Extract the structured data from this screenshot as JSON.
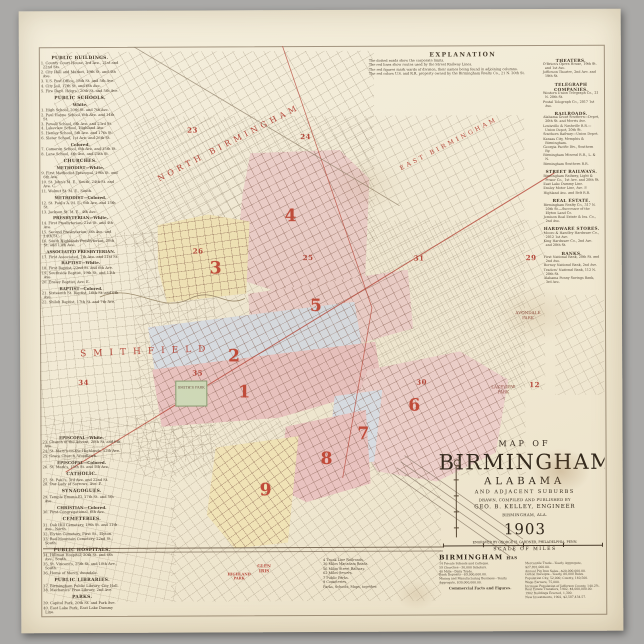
{
  "colors": {
    "red": "#b5473a",
    "pink": "#eccfca",
    "rose": "#e9c3c0",
    "yellow": "#f0e3b6",
    "blue": "#d8dde3",
    "paper": "#f2ecd9"
  },
  "explanation": {
    "title": "EXPLANATION",
    "lines": [
      "The dotted roads show the corporate limits.",
      "The red lines show routes used by the Street Railway Lines.",
      "The red figures mark wards of division, their names being found in adjoining columns.",
      "The red colors U.S. and R.R. property owned by the Birmingham Realty Co., 21 N. 20th St."
    ]
  },
  "left_top": {
    "rows": [
      {
        "t": "h",
        "x": "PUBLIC BUILDINGS."
      },
      {
        "t": "i",
        "x": "1. County Court House, 3rd Ave., 21st and 22nd Sts."
      },
      {
        "t": "i",
        "x": "2. City Hall and Market, 19th St. and 4th Ave."
      },
      {
        "t": "i",
        "x": "3. U.S. Post Office, 18th St. and 5th Ave."
      },
      {
        "t": "i",
        "x": "4. City Jail, 17th St. and 6th Ave."
      },
      {
        "t": "i",
        "x": "5. Fire Dept. Hdqrs., 20th St. and 5th Ave."
      },
      {
        "t": "h",
        "x": "PUBLIC SCHOOLS."
      },
      {
        "t": "s",
        "x": "White."
      },
      {
        "t": "i",
        "x": "1. High School, 20th St. and 7th Ave."
      },
      {
        "t": "i",
        "x": "2. Paul Hayne School, 6th Ave. and 14th St."
      },
      {
        "t": "i",
        "x": "3. Powell School, 6th Ave. and 23rd St."
      },
      {
        "t": "i",
        "x": "4. Lakeview School, Highland Ave."
      },
      {
        "t": "i",
        "x": "5. Henley School, 5th Ave. and 17th St."
      },
      {
        "t": "i",
        "x": "6. Slater School, 1st Ave. and 26th St."
      },
      {
        "t": "s",
        "x": "Colored."
      },
      {
        "t": "i",
        "x": "7. Cameron School, 6th Ave. and 15th St."
      },
      {
        "t": "i",
        "x": "8. Lane School, 4th Ave. and 24th St."
      },
      {
        "t": "h",
        "x": "CHURCHES."
      },
      {
        "t": "s",
        "x": "METHODIST—White."
      },
      {
        "t": "i",
        "x": "9. First Methodist Episcopal, 19th St. and 6th Ave."
      },
      {
        "t": "i",
        "x": "10. St. John's M. E., South, 24th St. and Ave. C."
      },
      {
        "t": "i",
        "x": "11. Walnut St. M. E., South."
      },
      {
        "t": "s",
        "x": "METHODIST—Colored."
      },
      {
        "t": "i",
        "x": "12. St. Paul's A. M. E., 6th Ave. and 15th St."
      },
      {
        "t": "i",
        "x": "13. Jackson St. M. E., 4th Ave."
      },
      {
        "t": "s",
        "x": "PRESBYTERIAN—White."
      },
      {
        "t": "i",
        "x": "14. First Presbyterian, 21st St. and 4th Ave."
      },
      {
        "t": "i",
        "x": "15. Second Presbyterian, 6th Ave. and 14th St."
      },
      {
        "t": "i",
        "x": "16. South Highlands Presbyterian, 20th St. and 11th Ave."
      },
      {
        "t": "s",
        "x": "ASSOCIATED PRESBYTERIAN."
      },
      {
        "t": "i",
        "x": "17. First Associated, 7th Ave. and 21st St."
      },
      {
        "t": "s",
        "x": "BAPTIST—White."
      },
      {
        "t": "i",
        "x": "18. First Baptist, 22nd St. and 6th Ave."
      },
      {
        "t": "i",
        "x": "19. Southside Baptist, 19th St. and 11th Ave."
      },
      {
        "t": "i",
        "x": "20. Ensley Baptist, Ave. E."
      },
      {
        "t": "s",
        "x": "BAPTIST—Colored."
      },
      {
        "t": "i",
        "x": "21. Sixteenth St. Baptist, 16th St. and 6th Ave."
      },
      {
        "t": "i",
        "x": "22. Shiloh Baptist, 17th St. and 7th Ave."
      }
    ]
  },
  "left_bottom": {
    "rows": [
      {
        "t": "s",
        "x": "EPISCOPAL—White."
      },
      {
        "t": "i",
        "x": "23. Church of the Advent, 20th St. and 6th Ave."
      },
      {
        "t": "i",
        "x": "24. St. Mary's-on-the-Highlands, 12th Ave."
      },
      {
        "t": "i",
        "x": "25. Grace Church, Woodlawn."
      },
      {
        "t": "s",
        "x": "EPISCOPAL—Colored."
      },
      {
        "t": "i",
        "x": "26. St. Mark's, 15th St. and 5th Ave."
      },
      {
        "t": "h",
        "x": "CATHOLIC."
      },
      {
        "t": "i",
        "x": "27. St. Paul's, 3rd Ave. and 22nd St."
      },
      {
        "t": "i",
        "x": "28. Our Lady of Sorrows, Ave. F."
      },
      {
        "t": "h",
        "x": "SYNAGOGUES."
      },
      {
        "t": "i",
        "x": "29. Temple Emanu-El, 17th St. and 5th Ave."
      },
      {
        "t": "s",
        "x": "CHRISTIAN—Colored."
      },
      {
        "t": "i",
        "x": "30. First Congregational, 6th Ave."
      },
      {
        "t": "h",
        "x": "CEMETERIES."
      },
      {
        "t": "i",
        "x": "31. Oak Hill Cemetery, 19th St. and 11th Ave., North."
      },
      {
        "t": "i",
        "x": "32. Elyton Cemetery, First St., Elyton."
      },
      {
        "t": "i",
        "x": "33. Red Mountain Cemetery, 22nd St., South."
      },
      {
        "t": "h",
        "x": "PUBLIC HOSPITALS."
      },
      {
        "t": "i",
        "x": "34. Hillman Hospital, 20th St. and 6th Ave., South."
      },
      {
        "t": "i",
        "x": "35. St. Vincent's, 25th St. and 10th Ave., South."
      },
      {
        "t": "i",
        "x": "36. Home of Mercy, Avondale."
      },
      {
        "t": "h",
        "x": "PUBLIC LIBRARIES."
      },
      {
        "t": "i",
        "x": "37. Birmingham Public Library, City Hall."
      },
      {
        "t": "i",
        "x": "38. Mechanics' Free Library, 2nd Ave."
      },
      {
        "t": "h",
        "x": "PARKS."
      },
      {
        "t": "i",
        "x": "39. Capitol Park, 20th St. and Park Ave."
      },
      {
        "t": "i",
        "x": "40. East Lake Park, East Lake Dummy Line."
      },
      {
        "t": "i",
        "x": "41. Lakeview Park, Highland Ave. and Clairmont."
      },
      {
        "t": "i",
        "x": "42. Avondale Park, 5th Ave., Avondale."
      },
      {
        "t": "i",
        "x": "43. Smith's Park, 8th Ave. and 8th St."
      },
      {
        "t": "i",
        "x": "44. Highland Park, Glen Iris and 11th Pl."
      },
      {
        "t": "i",
        "x": "45. Glen Iris Park, South Elyton."
      }
    ]
  },
  "right_col": {
    "rows": [
      {
        "t": "h",
        "x": "THEATERS."
      },
      {
        "t": "i",
        "x": "O'Brien's Opera House, 19th St. and 1st Ave."
      },
      {
        "t": "i",
        "x": "Jefferson Theatre, 2nd Ave. and 19th St."
      },
      {
        "t": "h",
        "x": "TELEGRAPH COMPANIES."
      },
      {
        "t": "i",
        "x": "Western Union Telegraph Co., 21 N. 20th St."
      },
      {
        "t": "i",
        "x": "Postal Telegraph Co., 2017 1st Ave."
      },
      {
        "t": "h",
        "x": "RAILROADS."
      },
      {
        "t": "i",
        "x": "Alabama Great Southern—Depot, 20th St. and Morris Ave."
      },
      {
        "t": "i",
        "x": "Louisville & Nashville R.R.—Union Depot, 20th St."
      },
      {
        "t": "i",
        "x": "Southern Railway—Union Depot."
      },
      {
        "t": "i",
        "x": "Kansas City, Memphis & Birmingham."
      },
      {
        "t": "i",
        "x": "Georgia Pacific Div., Southern Ry."
      },
      {
        "t": "i",
        "x": "Birmingham Mineral R.R., L. & N."
      },
      {
        "t": "i",
        "x": "Birmingham Southern R.R."
      },
      {
        "t": "h",
        "x": "STREET RAILWAYS."
      },
      {
        "t": "i",
        "x": "Birmingham Railway, Light & Power Co., 1st Ave. and 20th St."
      },
      {
        "t": "i",
        "x": "East Lake Dummy Line."
      },
      {
        "t": "i",
        "x": "Ensley Motor Line, Ave. F."
      },
      {
        "t": "i",
        "x": "Highland Ave. and Belt R.R."
      },
      {
        "t": "h",
        "x": "REAL ESTATE."
      },
      {
        "t": "i",
        "x": "Birmingham Realty Co., 317 N. 20th St.—Successor of the Elyton Land Co."
      },
      {
        "t": "i",
        "x": "Jemison Real Estate & Ins. Co., 2nd Ave."
      },
      {
        "t": "h",
        "x": "HARDWARE STORES."
      },
      {
        "t": "i",
        "x": "Moore & Handley Hardware Co., 2012 1st Ave."
      },
      {
        "t": "i",
        "x": "King Hardware Co., 2nd Ave. and 20th St."
      },
      {
        "t": "h",
        "x": "BANKS."
      },
      {
        "t": "i",
        "x": "First National Bank, 20th St. and 2nd Ave."
      },
      {
        "t": "i",
        "x": "Berney National Bank, 2nd Ave."
      },
      {
        "t": "i",
        "x": "Traders' National Bank, 112 N. 20th St."
      },
      {
        "t": "i",
        "x": "Alabama Penny Savings Bank, 3rd Ave."
      }
    ]
  },
  "map": {
    "district_numbers": [
      "1",
      "2",
      "3",
      "4",
      "5",
      "6",
      "7",
      "8",
      "9"
    ],
    "ward_numbers": [
      "23",
      "24",
      "26",
      "25",
      "31",
      "29",
      "35",
      "34",
      "30",
      "12"
    ],
    "labels": {
      "north_birmingham": "NORTH BIRMINGHAM",
      "east_birmingham": "EAST BIRMINGHAM",
      "smithfield": "SMITHFIELD",
      "avondale_park": "AVONDALE PARK",
      "lakeview_park": "LAKEVIEW PARK",
      "smiths_park": "SMITH'S PARK",
      "highland_park": "HIGHLAND PARK",
      "glen_iris": "GLEN IRIS"
    }
  },
  "title_block": {
    "map_of": "MAP OF",
    "city": "BIRMINGHAM",
    "state": "ALABAMA",
    "suburbs": "AND ADJACENT SUBURBS",
    "drawn": "DRAWN, COMPILED AND PUBLISHED BY",
    "author": "GEO. B. KELLEY, ENGINEER",
    "place": "BIRMINGHAM, ALA.",
    "year": "1903",
    "engraved": "ENGRAVED BY GEORGE H. GARDNER, PHILADELPHIA, PENN.",
    "scale": "SCALE OF MILES"
  },
  "index": {
    "heading": "BIRMINGHAM",
    "lines": [
      "4 Trunk Line Railroads.",
      "30 Miles Macadam Roads.",
      "56 Miles Street Railway.",
      "62 Miles Sewers.",
      "7 Public Parks.",
      "9 Cemeteries.",
      "Parks, Schools, Maps, together."
    ]
  },
  "stats": {
    "heading_main": "BIRMINGHAM",
    "heading_suffix": "HAS",
    "left": [
      "14 Private Schools and Colleges.",
      "59 Churches—30,000 Scholars.",
      "40 Mills—Daily Trade.",
      "Bank Deposits—$9,000,000.00.",
      "Mining and Manufacturing Business—Yearly Aggregate, $30,000,000.00."
    ],
    "subhead": "Commercial Facts and Figures.",
    "right": [
      "Mercantile Trade—Yearly Aggregate, $27,891,000.00.",
      "Annual Pig Iron Sales—$20,000,000.00.",
      "Cotton Receipts—Yearly, 80,000 Bales.",
      "Population City, 52,000; County, 140,500.",
      "Wage Earners, 75,000.",
      "Increase Population of Jefferson County, 140.2%.",
      "Real Estate Transfers, 1902, $4,000,000.00.",
      "1902 Buildings Erected, 1,300.",
      "New Investments, 1902, $2,587,434.57."
    ]
  }
}
